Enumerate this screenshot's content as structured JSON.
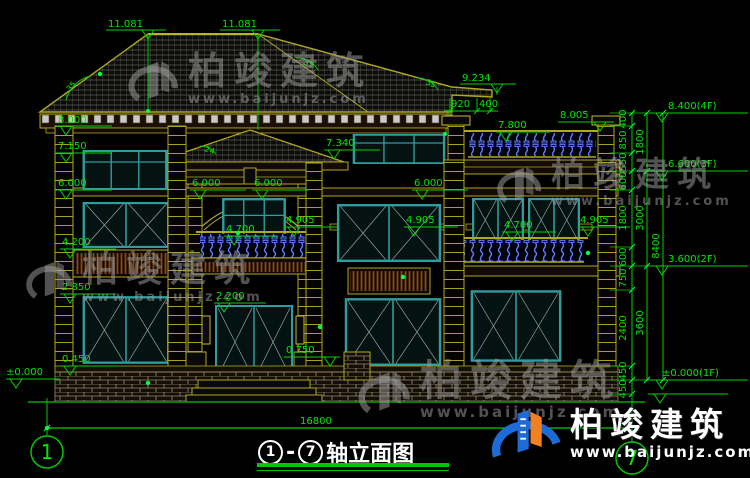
{
  "document": {
    "title": {
      "axis_from": "1",
      "separator": "-",
      "axis_to": "7",
      "text": "轴立面图"
    },
    "axis_bubbles": {
      "left": "1",
      "right": "7"
    }
  },
  "levels": {
    "ridge_left": "11.081",
    "ridge_right": "11.081",
    "upper_eave": "9.234",
    "main_eave": "8.000",
    "l7150": "7.150",
    "l7340": "7.340",
    "l7800": "7.800",
    "l8005": "8.005",
    "l6000_a": "6.000",
    "l6000_b": "6.000",
    "l6000_c": "6.000",
    "l6000_d": "6.000",
    "l4905_a": "4.905",
    "l4905_b": "4.905",
    "l4905_c": "4.905",
    "l4700_a": "4.700",
    "l4700_b": "4.700",
    "l4200": "4.200",
    "l2850": "2.850",
    "l2200": "2.200",
    "l0750": "0.750",
    "l0450": "0.450",
    "l0000": "±0.000"
  },
  "dims": {
    "d920": "920",
    "d400": "400",
    "total": "16800"
  },
  "right_chain": {
    "inner": [
      "400",
      "850",
      "550",
      "600",
      "1800",
      "600",
      "750",
      "2400",
      "450",
      "450"
    ],
    "middle": [
      "1800",
      "3000",
      "3600"
    ],
    "overall": "8400",
    "floors": [
      "8.400(4F)",
      "6.600(3F)",
      "3.600(2F)",
      "±0.000(1F)"
    ]
  },
  "angles": {
    "a1": "35",
    "a2": "35",
    "a3": "35",
    "a4": "24"
  },
  "watermark": {
    "brand": "柏竣建筑",
    "site": "www.baijunjz.com"
  },
  "colors": {
    "background": "#000000",
    "dim_green": "#00d400",
    "cad_yellow": "#b0a820",
    "window_teal": "#2d9d9d",
    "baluster_blue": "#5c7cff",
    "logo_blue": "#1e6bd6",
    "logo_orange": "#f08020",
    "title_white": "#ffffff"
  }
}
